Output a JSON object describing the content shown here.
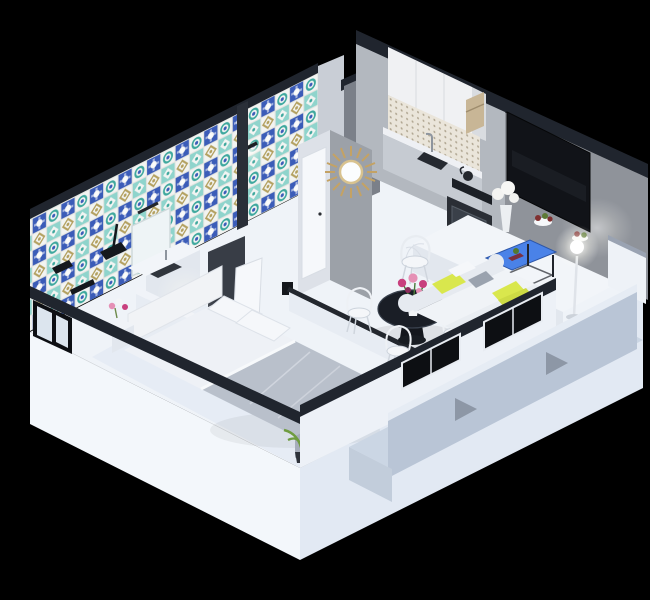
{
  "scene": {
    "description": "3D isometric cutaway floor-plan render of a one-bedroom apartment on a black background",
    "style": "isometric-3d-render",
    "rooms": {
      "bathroom": {
        "features": [
          "moroccan-tiled-walls",
          "black-shower-fixture",
          "towel-bar",
          "vanity-counter",
          "vanity-mirror",
          "wall-sconce",
          "frosted-corner-window"
        ]
      },
      "entry_hall": {
        "features": [
          "sunburst-mirror",
          "white-door",
          "gray-accent-wall",
          "entry-niche"
        ]
      },
      "kitchen": {
        "features": [
          "white-upper-cabinets",
          "tiled-backsplash",
          "sink-with-faucet",
          "cooktop-with-kettle",
          "oven",
          "wood-open-shelf"
        ]
      },
      "living_dining": {
        "features": [
          "wall-mounted-tv",
          "white-island-counter",
          "fruit-bowls",
          "glowing-floor-lamp",
          "white-sofa-with-yellow-pillows",
          "blue-coffee-table",
          "round-black-dining-table",
          "pink-flower-vase",
          "white-wireframe-chairs",
          "front-window-band"
        ]
      },
      "bedroom": {
        "features": [
          "double-bed",
          "gray-duvet",
          "white-sheets",
          "headboard",
          "pillows",
          "nightstand-with-flowers",
          "potted-plant",
          "open-doorway",
          "low-divider-wall"
        ]
      },
      "balcony": {
        "features": [
          "blue-gray-floor",
          "parapet-wall",
          "white-corner-return",
          "support-brackets",
          "window-wall"
        ]
      }
    },
    "palette": {
      "background": "#000000",
      "plinth_white": "#f3f7fb",
      "plinth_shadow": "#e2e9f3",
      "floor": "#eff3f8",
      "bedroom_floor": "#e4eaf4",
      "wall_band": "#20252e",
      "back_wall_gray": "#8f939a",
      "kitchen_wall": "#b3b8bf",
      "slab_gray": "#7b8089",
      "niche_gray": "#c9ced6",
      "column_gray": "#9ca1a8",
      "column_light": "#dde1e8",
      "wall_white": "#edf1f7",
      "interior_wall": "#e7ecf3",
      "tv_black": "#111318",
      "cabinet_white": "#f0f1f3",
      "backsplash": "#eae5da",
      "backsplash_dot": "#b2a894",
      "counter_gray": "#c6cbd2",
      "counter_top": "#eef0f4",
      "appliance_dark": "#262a31",
      "oven_dark": "#2a2e35",
      "wood_shelf": "#c8b696",
      "island_top": "#f2f5f9",
      "island_face": "#e2e7ee",
      "sofa_base": "#e6eaf0",
      "sofa_seat": "#f0f3f7",
      "pillow_yellow": "#d9e74d",
      "pillow_gray": "#9aa2ae",
      "throw_chartreuse": "#cddb44",
      "coffee_blue": "#4a82e8",
      "table_black": "#1a1e26",
      "flower_magenta": "#c8407e",
      "flower_pink": "#e590b5",
      "leaf_green": "#53792f",
      "duvet": "#b9c0cb",
      "duvet_side": "#a6adba",
      "sheet": "#eef1f6",
      "pillow_white": "#f5f7fa",
      "headboard": "#f1f3f6",
      "plant": "#6f9c3f",
      "plant_dark": "#4f7a2c",
      "balcony_floor": "#cbd6e4",
      "parapet": "#b9c5d6",
      "parapet_top": "#e6ecf4",
      "bracket": "#8d97a6",
      "white_return": "#eef2f7",
      "mirror_gold": "#c4a264",
      "door_white": "#f6f8fb",
      "doorway": "#383d46",
      "window_black": "#0d0f13",
      "glass": "#dce5ee",
      "tile_blue": "#3b5cb8",
      "tile_teal": "#3fa89e",
      "tile_aqua": "#8fd4cc",
      "tile_beige": "#b3a05f",
      "tile_white": "#f2f4f2",
      "grout": "#e3e4e0"
    }
  }
}
